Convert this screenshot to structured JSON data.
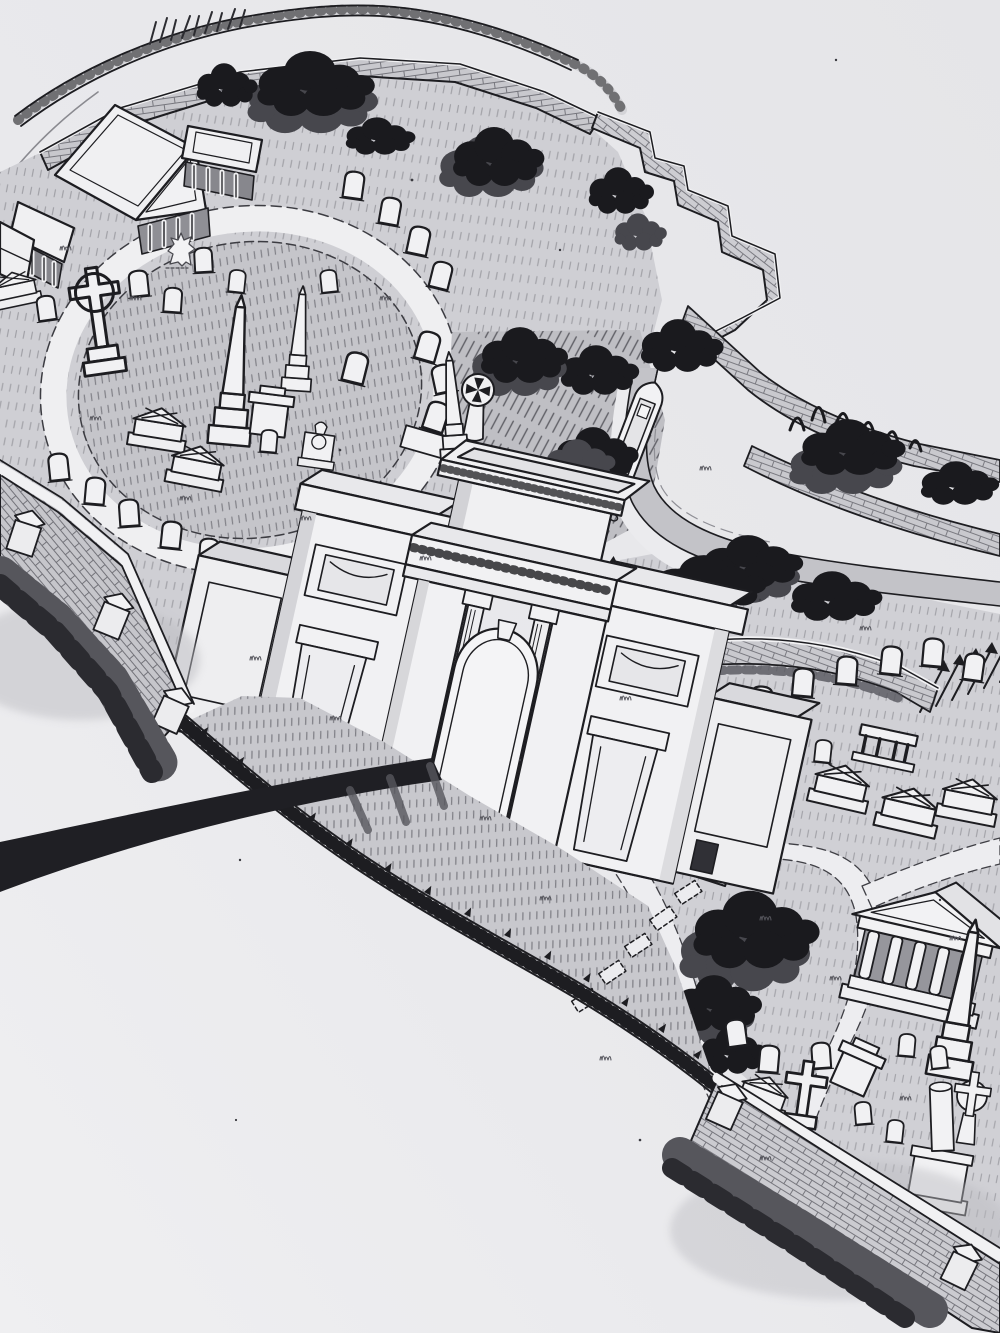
{
  "artwork": {
    "kind": "hand-drawn black-and-white ink illustration",
    "subject": "aerial oblique view of a walled garden cemetery with canal",
    "visible_text": ""
  },
  "palette": {
    "paper": "#e9e9ec",
    "ink": "#1d1d21",
    "wash_light": "#dcdce0",
    "wash_mid": "#c9c9ce",
    "wash_dark": "#a9a9af",
    "foliage": "#1a1a1e",
    "foliage_mid": "#47474d",
    "water": "#c3c3c8",
    "stone_white": "#f1f1f3",
    "shadow": "#2b2b30"
  },
  "features": {
    "illustration": "ink illustration of a victorian cemetery seen from above",
    "outer_wall": "thin outer boundary wall and lane at top edge",
    "north_wall": "main north boundary brick wall",
    "stepped_wall": "stepped brick wall descending the slope at top right",
    "west_wall": "west boundary brick wall with stone piers",
    "south_wall": "south boundary brick wall with stone piers",
    "shadow_hedge": "dark shadow hedging outside the walls",
    "service_road": "dark lane running off to the lower left",
    "chapel": "cemetery chapel with pediment and colonnade wings",
    "angel_statue": "small angel statue",
    "circular_plot": "circular burial plot ringed by a white path",
    "obelisk_primary": "tall obelisk monument",
    "obelisk_secondary": "smaller obelisk monument",
    "celtic_cross": "celtic cross monument",
    "cross_pattee": "round cross-pattee monument on the bank",
    "headstones": "scattered headstones",
    "chest_tombs": "chest tombs with gabled lids",
    "topiary": "row of clipped topiary bushes",
    "scrub_bank": "steep hatched bank with dark trees",
    "woodland": "dense dark tree canopies",
    "canal": "canal curving around the cemetery",
    "towpath": "canal towpath",
    "embankment": "brick canal embankment walls",
    "narrowboat": "narrowboat moored on the canal",
    "entrance_arch": "grand triumphal entrance archway",
    "left_pavilion": "left gate pavilion",
    "right_pavilion": "right gate pavilion",
    "wing_walls": "flanking wing walls of the gateway",
    "iron_fence": "curved iron railing fence with spear finials",
    "spear_railings": "rows of spear-topped railings",
    "entrance_lawn": "grass apron inside the entrance railings",
    "grave_slabs": "line of flat grave markers",
    "east_field": "south-east burial field",
    "mausoleum": "small classical temple mausoleum",
    "obelisk_east": "obelisk in the south-east field",
    "broken_column": "broken column monument",
    "wheel_cross": "wheel-head cross monument",
    "paths": "white gravel paths"
  }
}
